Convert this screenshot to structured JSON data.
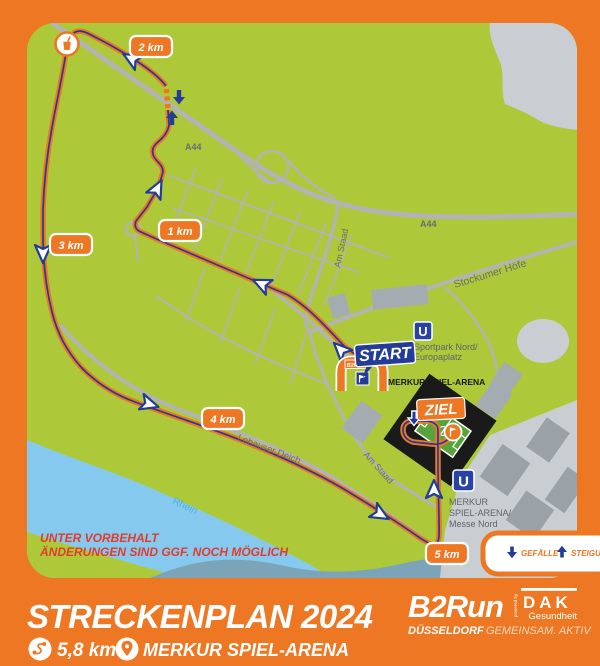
{
  "map": {
    "km_markers": [
      {
        "label": "1 km"
      },
      {
        "label": "2 km"
      },
      {
        "label": "3 km"
      },
      {
        "label": "4 km"
      },
      {
        "label": "5 km"
      }
    ],
    "start": {
      "label": "START",
      "flag": "B2Run"
    },
    "finish": {
      "label": "ZIEL"
    },
    "arena_label": "MERKUR SPIEL-ARENA",
    "stations": [
      {
        "symbol": "U",
        "lines": [
          "Sportpark Nord/",
          "Europaplatz"
        ]
      },
      {
        "symbol": "U",
        "lines": [
          "MERKUR",
          "SPIEL-ARENA/",
          "Messe Nord"
        ]
      }
    ],
    "roads": {
      "a44_west": "A44",
      "a44_east": "A44",
      "am_staad_north": "Am Staad",
      "am_staad_south": "Am Staad",
      "stockumer_hoefe": "Stockumer Höfe",
      "lohauser_deich": "Lohauser Deich"
    },
    "river": "Rhein",
    "disclaimer_line1": "UNTER VORBEHALT",
    "disclaimer_line2": "ÄNDERUNGEN SIND GGF. NOCH MÖGLICH",
    "legend": {
      "descent": "GEFÄLLE",
      "climb": "STEIGUNG"
    }
  },
  "footer": {
    "title": "STRECKENPLAN 2024",
    "distance": "5,8 km",
    "venue": "MERKUR SPIEL-ARENA",
    "logo": {
      "brand": "B2Run",
      "powered_by": "powered by",
      "partner": "DAK",
      "partner_sub": "Gesundheit",
      "city": "DÜSSELDORF",
      "tagline": "GEMEINSAM. AKTIV"
    }
  },
  "colors": {
    "frame_orange": "#ED7722",
    "map_green": "#ADC939",
    "navy": "#233C98",
    "water_blue": "#85CAEE",
    "road_gray": "#B3B3B3",
    "disclaimer_red": "#E5392B"
  }
}
